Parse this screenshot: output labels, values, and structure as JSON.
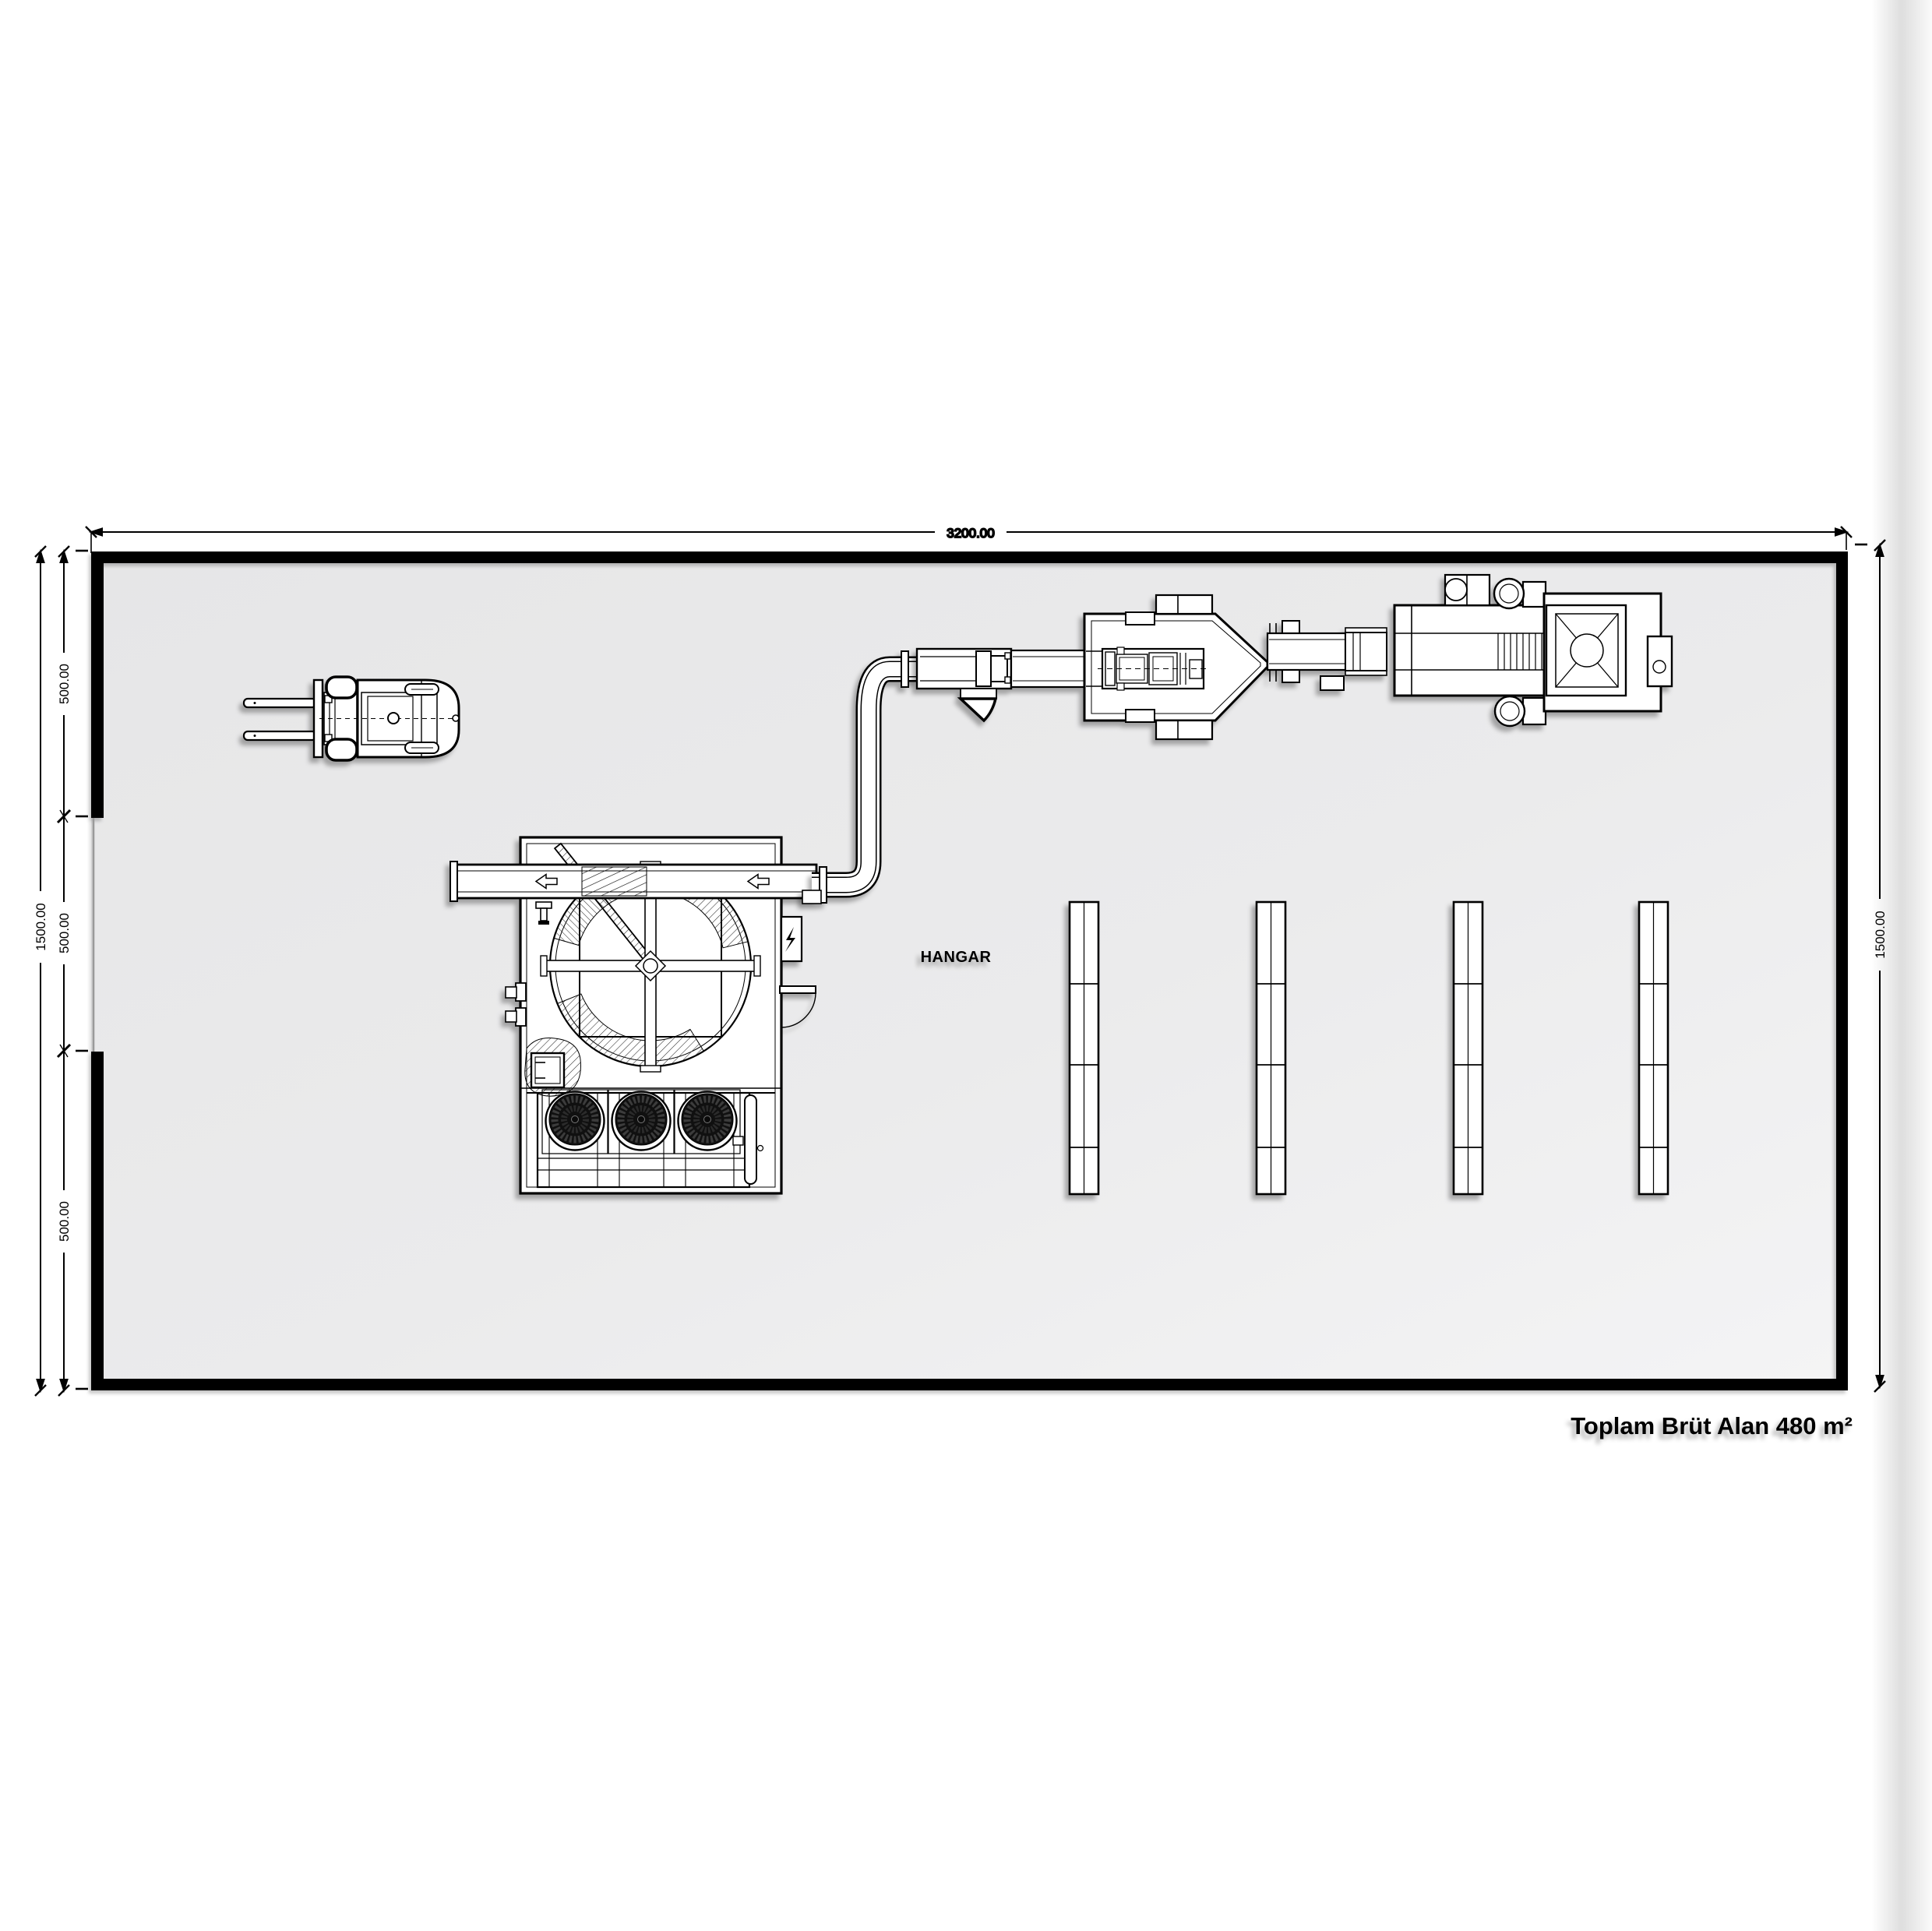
{
  "plan": {
    "room_label": "HANGAR",
    "area_note": "Toplam Brüt Alan 480 m²",
    "dimensions": {
      "top_width": "3200.00",
      "left_overall": "1500.00",
      "right_overall": "1500.00",
      "left_segments": [
        "500.00",
        "500.00",
        "500.00"
      ]
    },
    "colors": {
      "floor_dark": "#e7e7e8",
      "floor_light": "#f3f3f4",
      "line": "#000000",
      "equipment_fill": "#ffffff"
    },
    "equipment": [
      "forklift",
      "rotary-drum-machine",
      "axial-fan-bank",
      "transfer-duct",
      "processing-line",
      "pallet-rack-1",
      "pallet-rack-2",
      "pallet-rack-3",
      "pallet-rack-4"
    ]
  }
}
